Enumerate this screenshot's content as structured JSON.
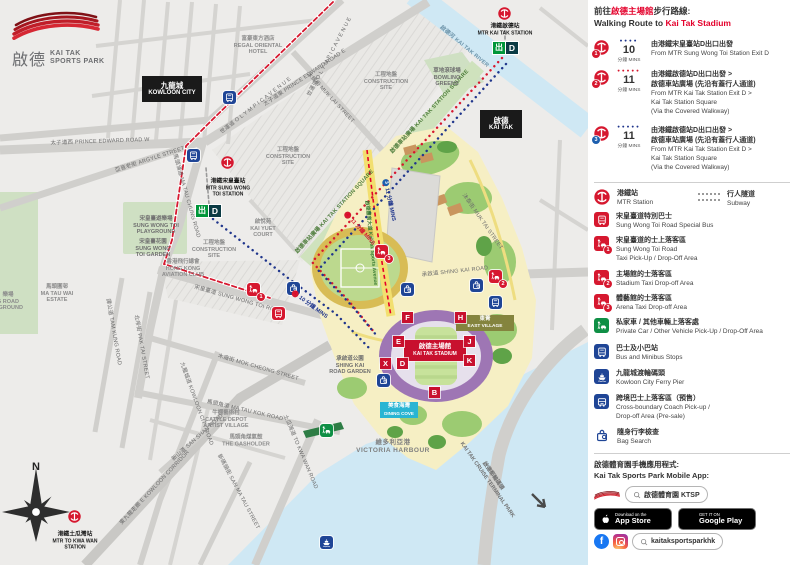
{
  "brand": {
    "zh": "啟德",
    "en": "KAI TAK\nSPORTS PARK"
  },
  "panel": {
    "title": {
      "zh_pre": "前往",
      "zh_red": "啟德主場館",
      "zh_post": "步行路線:",
      "en_pre": "Walking Route to ",
      "en_red": "Kai Tak Stadium"
    },
    "routes": [
      {
        "badge": "1",
        "dots": "●●●●",
        "time": "10",
        "unit": "分鐘 MINS",
        "zh": "由港鐵宋皇臺站D出口出發",
        "en": "From MTR Sung Wong Toi Station Exit D"
      },
      {
        "badge": "2",
        "dots": "●●●●●",
        "time": "11",
        "unit": "分鐘 MINS",
        "zh": "由港鐵啟德站D出口出發 >\n啟德車站廣場 (先沿有蓋行人通道)",
        "en": "From MTR Kai Tak Station Exit D >\nKai Tak Station Square\n(Via the Covered Walkway)"
      },
      {
        "badge": "3",
        "dots": "●●●●●",
        "time": "11",
        "unit": "分鐘 MINS",
        "zh": "由港鐵啟德站D出口出發 >\n啟德車站廣場 (先沿有蓋行人通道)",
        "en": "From MTR Kai Tak Station Exit D >\nKai Tak Station Square\n(Via the Covered Walkway)"
      }
    ],
    "legend": [
      {
        "zh": "港鐵站",
        "en": "MTR Station"
      },
      {
        "zh": "宋皇臺道特別巴士",
        "en": "Sung Wong Toi Road Special Bus"
      },
      {
        "zh": "宋皇臺道的士上落客區",
        "en": "Sung Wong Toi Road\nTaxi Pick-Up / Drop-Off Area"
      },
      {
        "zh": "主場館的士落客區",
        "en": "Stadium Taxi Drop-off Area"
      },
      {
        "zh": "體藝館的士落客區",
        "en": "Arena Taxi Drop-off Area"
      },
      {
        "zh": "私家車 / 其他車輛上落客處",
        "en": "Private Car / Other Vehicle Pick-Up / Drop-Off Area"
      },
      {
        "zh": "巴士及小巴站",
        "en": "Bus and Minibus Stops"
      },
      {
        "zh": "九龍城渡輪碼頭",
        "en": "Kowloon City Ferry Pier"
      },
      {
        "zh": "跨境巴士上落客區（預售）",
        "en": "Cross-boundary Coach Pick-up /\nDrop-off Area (Pre-sale)"
      },
      {
        "zh": "隨身行李檢查",
        "en": "Bag Search"
      }
    ],
    "subway": {
      "zh": "行人隧道",
      "en": "Subway"
    },
    "badges_legend": {
      "taxi1": "1",
      "taxi2": "2",
      "taxi3": "3"
    },
    "app": {
      "title_zh": "啟德體育園手機應用程式:",
      "title_en": "Kai Tak Sports Park Mobile App:",
      "ktsp_search": "啟德體育園 KTSP",
      "appstore_small": "Download on the",
      "appstore_big": "App Store",
      "gplay_small": "GET IT ON",
      "gplay_big": "Google Play",
      "social_search": "kaitaksportsparkhk",
      "fb_letter": "f"
    }
  },
  "map": {
    "north": "N",
    "boxes": {
      "kowloon_city_zh": "九龍城",
      "kowloon_city_en": "KOWLOON CITY",
      "kai_tak_zh": "啟德",
      "kai_tak_en": "KAI TAK",
      "stadium_zh": "啟德主場館",
      "stadium_en": "KAI TAK STADIUM",
      "dining_zh": "美食海灣",
      "dining_en": "DINING COVE",
      "east_village_zh": "東菁",
      "east_village_en": "EAST VILLAGE"
    },
    "stations": {
      "swt_zh": "港鐵宋皇臺站",
      "swt_en": "MTR SUNG WONG\nTOI STATION",
      "kt_zh": "港鐵啟德站",
      "kt_en": "MTR KAI TAK STATION",
      "tkw_zh": "港鐵土瓜灣站",
      "tkw_en": "MTR TO KWA WAN\nSTATION",
      "exit_zh": "出",
      "exit_letter": "D"
    },
    "roads": {
      "prince_w": "太子道西 PRINCE EDWARD ROAD W",
      "prince_e": "太子道東 PRINCE EDWARD ROAD E",
      "olympic": "世運道 O L Y M P I C  A V E N U E",
      "argyle": "亞皆老街 ARGYLE STREET",
      "ma_tau_chung": "馬頭涌道 MA TAU CHUNG ROAD",
      "muk_lai": "沐縭街 MUK LAI STREET",
      "muk_tai": "沐泰街 MUK TAI STREET",
      "swt_road": "宋皇臺道 SUNG WONG TOI ROAD",
      "mok_cheong": "木廠街 MOK CHEONG STREET",
      "ma_tau_kok": "馬頭角道 MA TAU KOK ROAD",
      "to_kwa_wan": "土瓜灣道 TO KWA WAN ROAD",
      "san_ma_tau": "新碼頭街 SAN MA TAU STREET",
      "kowloon_city_rd": "九龍城道 KOWLOON CITY ROAD",
      "e_kln": "東九龍走廊 E KOWLOON CORRIDOR",
      "san_shan": "新山道 SAN SHAN ROAD",
      "tam_kung": "譚公道 TAM KUNG ROAD",
      "pak_tai": "北帝街 PAK TAI STREET",
      "shing_kai": "承啟道 SHING KAI ROAD",
      "river": "啟德河 KAI TAK RIVER",
      "station_sq": "啟德車站廣場 KAI TAK STATION SQUARE",
      "sports_ave": "啟德體育大道 Kai Tak Sports Avenue"
    },
    "places": {
      "regal": "富豪東方酒店\nREGAL ORIENTAL\nHOTEL",
      "construction": "工程地盤\nCONSTRUCTION\nSITE",
      "bowling": "草地滾球場\nBOWLING\nGREENS",
      "kai_yuet": "啟悅苑\nKAI YUET\nCOURT",
      "swt_playground": "宋皇臺遊樂場\nSUNG WONG TOI\nPLAYGROUND",
      "swt_garden": "宋皇臺花園\nSUNG WONG\nTOI GARDEN",
      "aviation": "香港飛行總會\nHONG KONG\nAVIATION CLUB",
      "ma_tau_wai": "馬頭圍邨\nMA TAU WAI\nESTATE",
      "left_clip": "樂場\nG ROAD\nN GROUND",
      "cattle": "牛棚藝術村\nCATTLE DEPOT\nARTIST VILLAGE",
      "gasholder": "馬頭角煤氣鼓\nTHE GASHOLDER",
      "victoria": "維多利亞港\nVICTORIA HARBOUR",
      "skr_garden": "承啟道公園\nSHING KAI\nROAD GARDEN",
      "cruise": "啟德郵輪碼頭\nKAI TAK CRUISE TERMINAL PARK"
    },
    "route_marks": {
      "r1_n": "1",
      "r1_t": "10 分鐘 MINS",
      "r2_n": "2",
      "r2_t": "11 分鐘 MINS",
      "r3_n": "3",
      "r3_t": "11 分鐘 MINS"
    },
    "gates": {
      "f": "F",
      "h": "H",
      "e": "E",
      "j": "J",
      "k": "K",
      "x": "X",
      "d": "D",
      "b": "B"
    }
  }
}
